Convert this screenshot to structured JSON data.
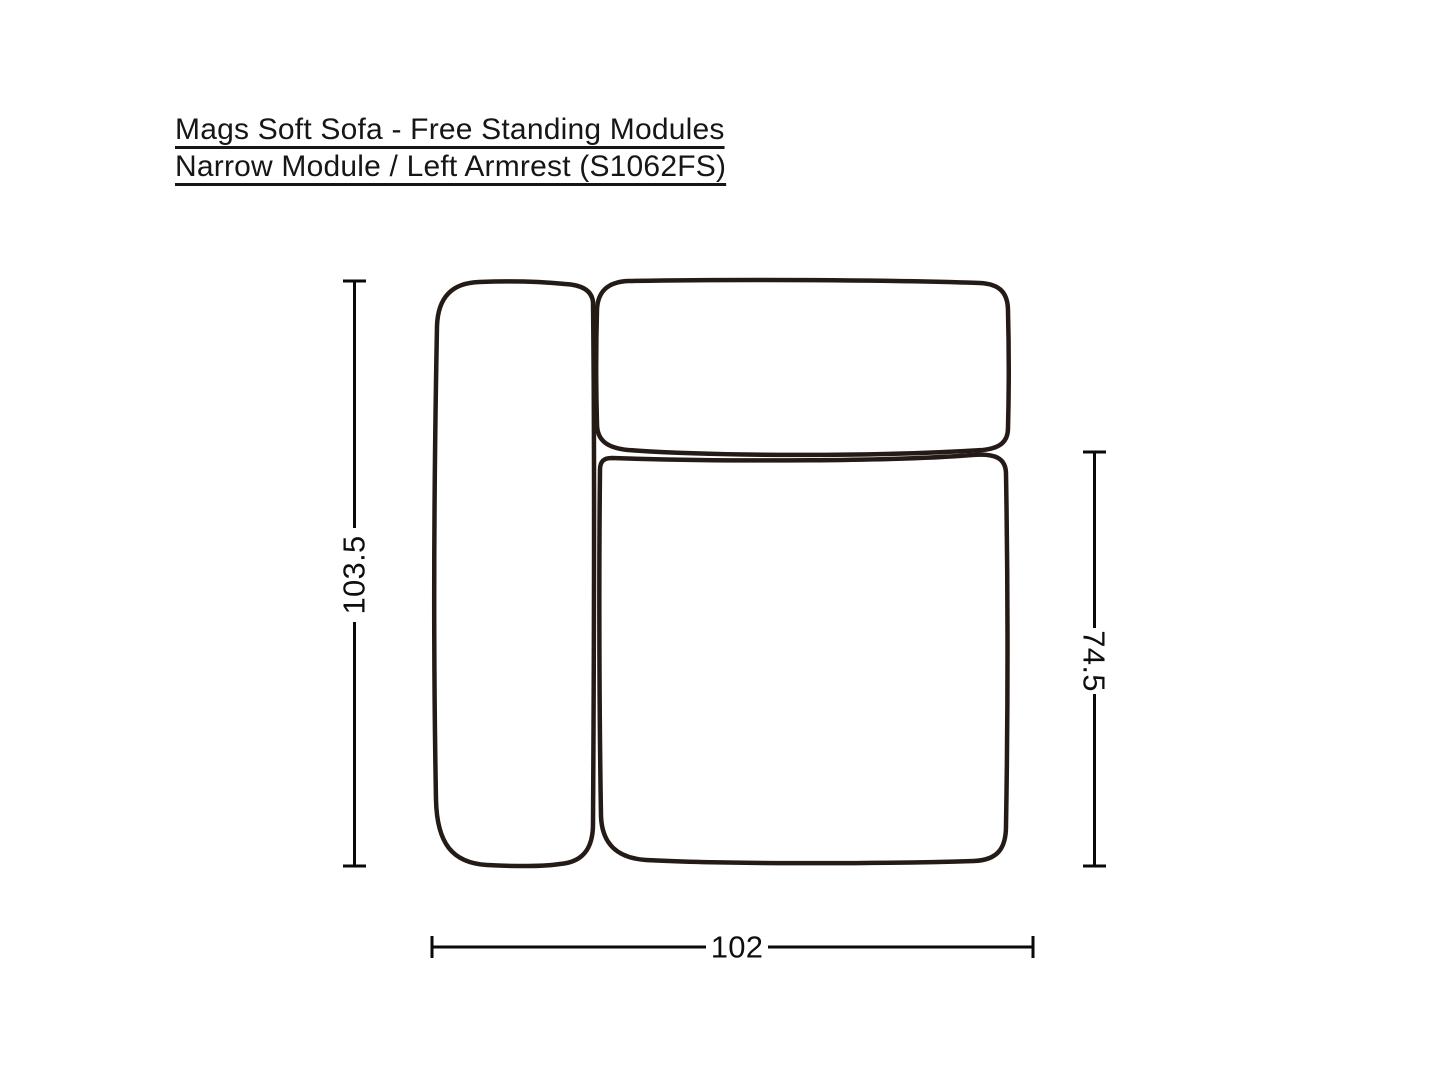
{
  "title": {
    "line1": "Mags Soft Sofa - Free Standing Modules",
    "line2": "Narrow Module / Left Armrest (S1062FS)"
  },
  "dimensions": {
    "left": {
      "value": "103.5",
      "orientation": "vertical"
    },
    "right": {
      "value": "74.5",
      "orientation": "vertical"
    },
    "bottom": {
      "value": "102",
      "orientation": "horizontal"
    }
  },
  "colors": {
    "background": "#ffffff",
    "sofa_outline": "#241b17",
    "dimension_line": "#0a0a0a",
    "text": "#161616"
  }
}
